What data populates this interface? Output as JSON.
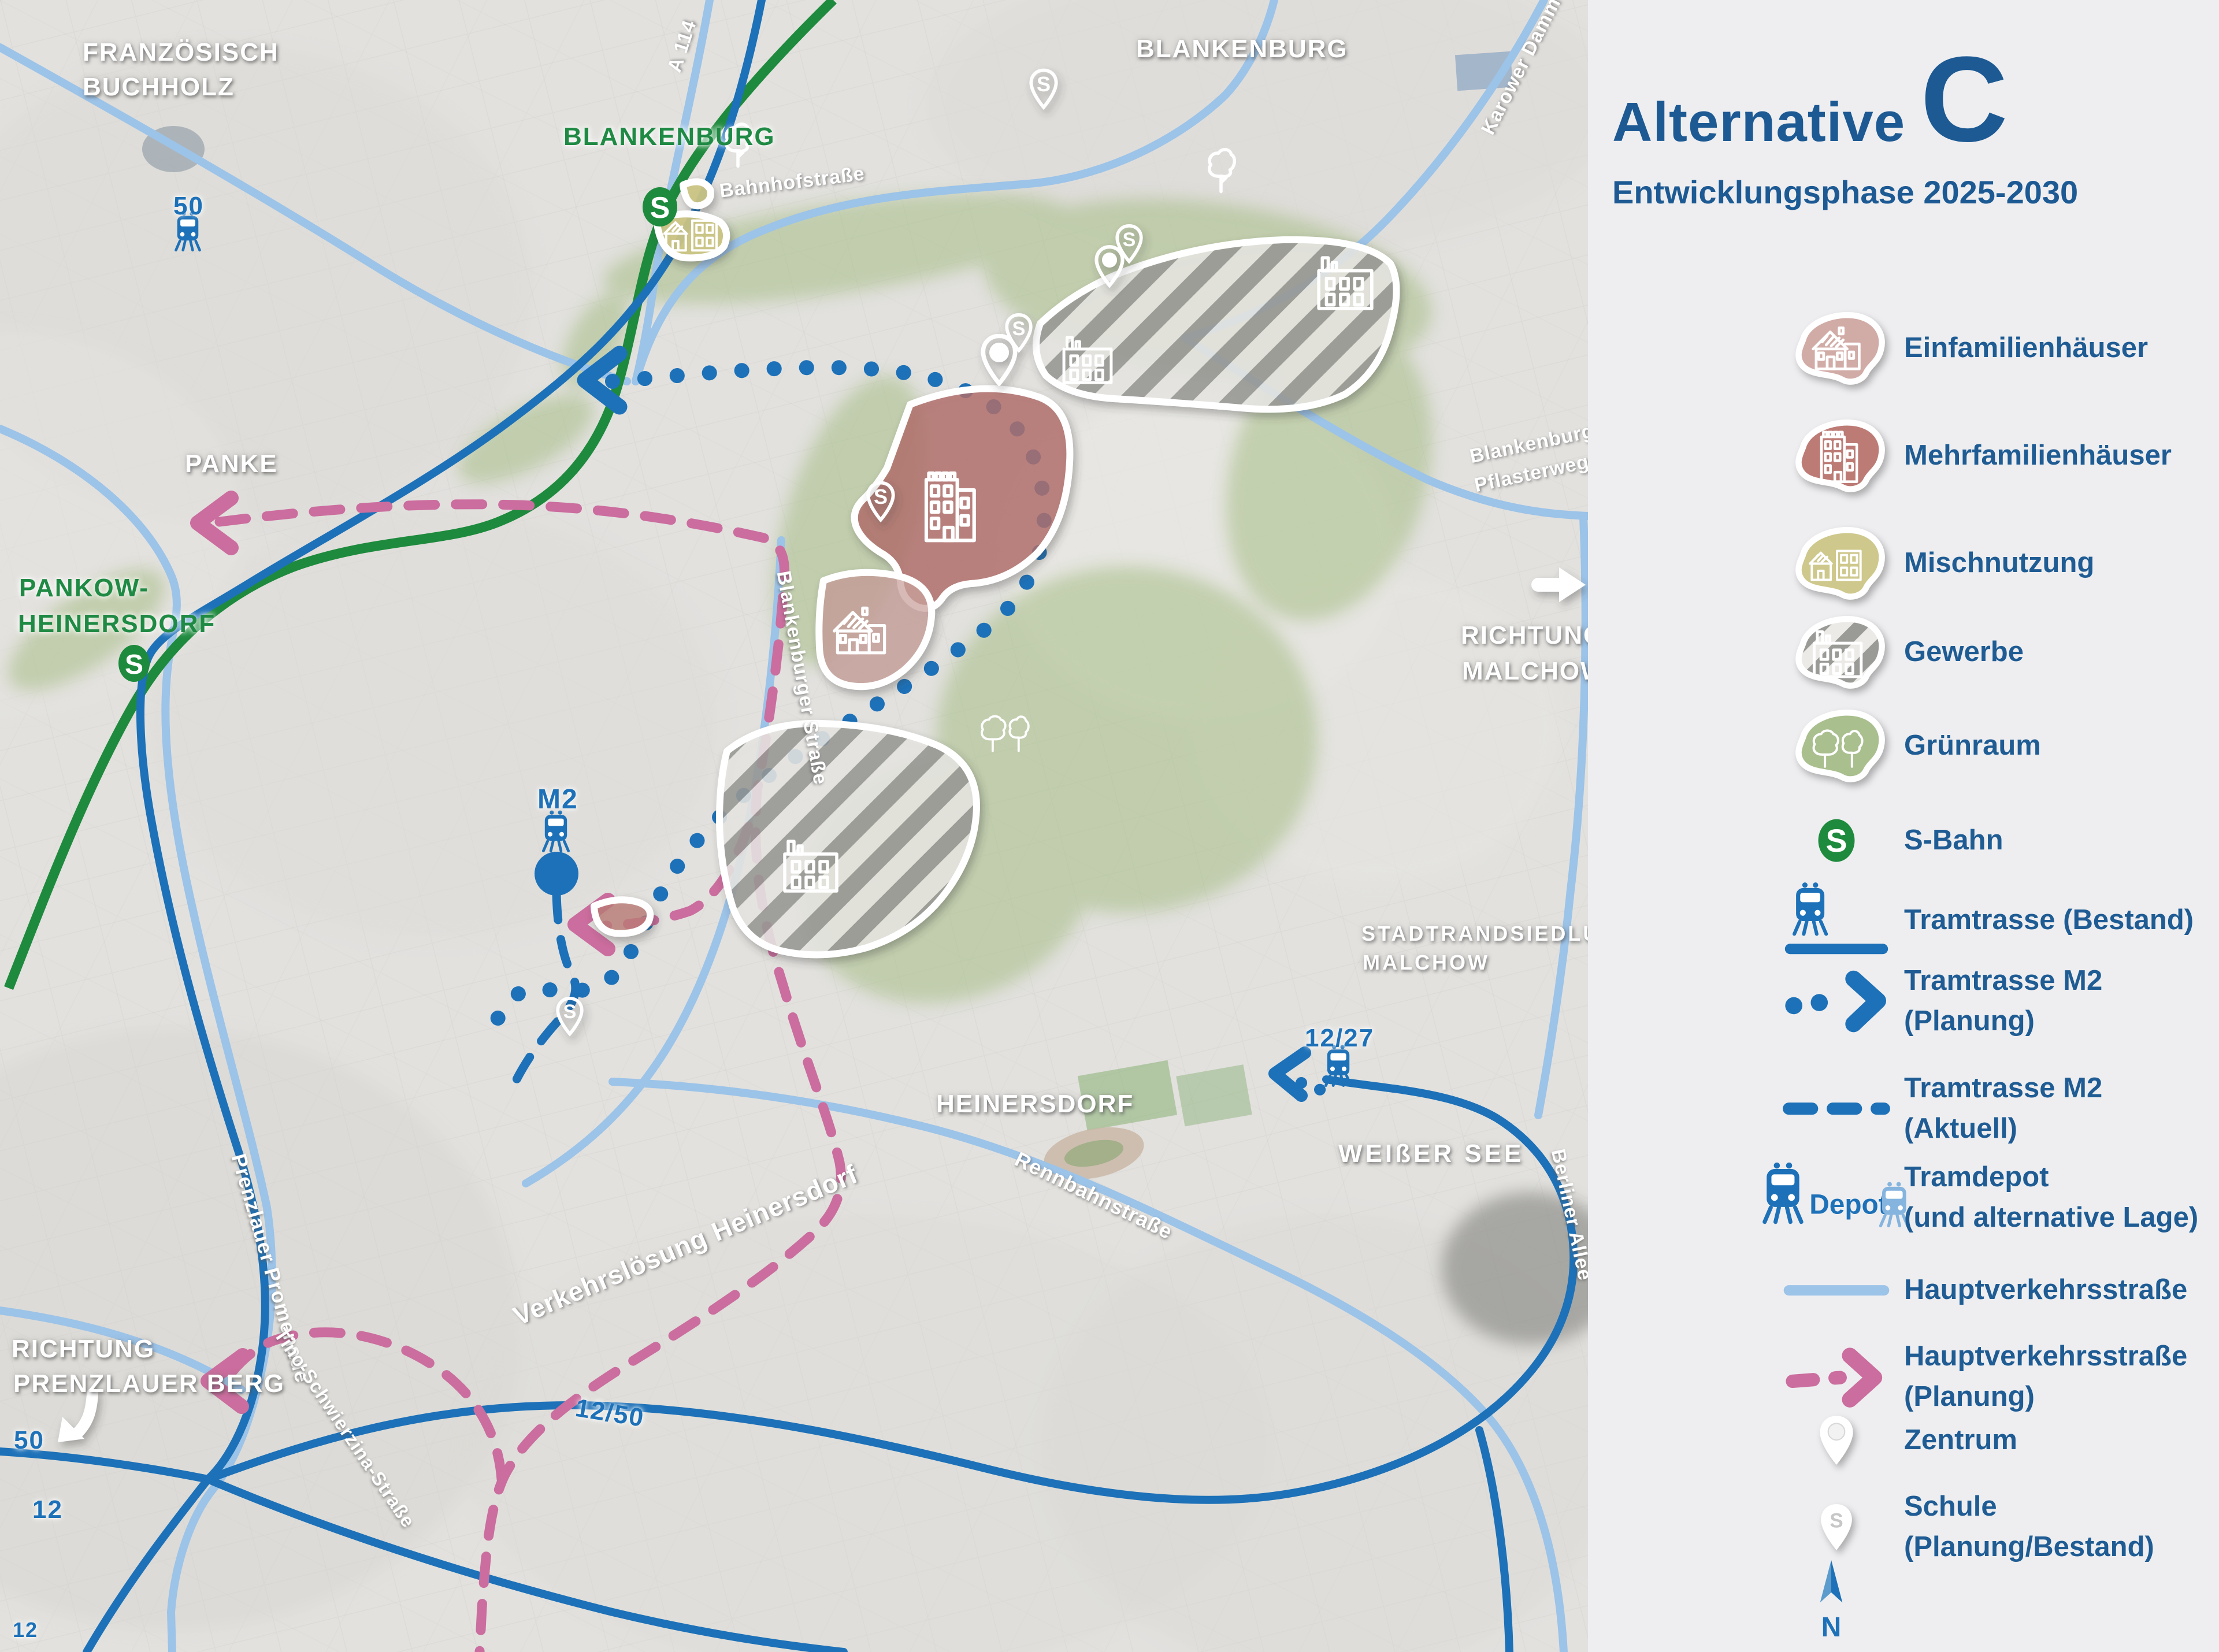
{
  "theme": {
    "accent_blue": "#1d5a94",
    "tram_blue": "#1d71b8",
    "tram_blue_light": "#85b4de",
    "road_lightblue": "#9cc3e8",
    "sbahn_green": "#1e8a3d",
    "planning_pink": "#cb6d9e",
    "einfamilien_color": "#d1aba6",
    "mehrfamilien_color": "#bd7b76",
    "mischnutzung_color": "#cec88c",
    "gruenraum_color": "#a9bf8e",
    "gewerbe_stripe_color": "#9a9a97",
    "legend_bg": "#eeeef0"
  },
  "legend": {
    "title_prefix": "Alternative",
    "title_letter": "C",
    "subtitle": "Entwicklungsphase 2025-2030",
    "depot_label": "Depot",
    "compass_letter": "N",
    "sbahn_letter": "S",
    "schule_letter": "S",
    "items": [
      {
        "label": "Einfamilienhäuser"
      },
      {
        "label": "Mehrfamilienhäuser"
      },
      {
        "label": "Mischnutzung"
      },
      {
        "label": "Gewerbe"
      },
      {
        "label": "Grünraum"
      },
      {
        "label": "S-Bahn"
      },
      {
        "label": "Tramtrasse (Bestand)"
      },
      {
        "label": "Tramtrasse M2",
        "label2": "(Planung)"
      },
      {
        "label": "Tramtrasse M2",
        "label2": "(Aktuell)"
      },
      {
        "label": "Tramdepot",
        "label2": "(und alternative Lage)"
      },
      {
        "label": "Hauptverkehrsstraße"
      },
      {
        "label": "Hauptverkehrsstraße",
        "label2": "(Planung)"
      },
      {
        "label": "Zentrum"
      },
      {
        "label": "Schule",
        "label2": "(Planung/Bestand)"
      }
    ]
  },
  "map": {
    "sbahn_letter": "S",
    "pin_letter": "S",
    "area_labels": {
      "franzoesisch_line1": "FRANZÖSISCH",
      "franzoesisch_line2": "BUCHHOLZ",
      "blankenburg_green": "BLANKENBURG",
      "blankenburg": "BLANKENBURG",
      "panke": "PANKE",
      "pankow_line1": "PANKOW-",
      "pankow_line2": "HEINERSDORF",
      "richtung_malchow_line1": "RICHTUNG",
      "richtung_malchow_line2": "MALCHOW",
      "stadtrand_line1": "STADTRANDSIEDLUNG",
      "stadtrand_line2": "MALCHOW",
      "heinersdorf": "HEINERSDORF",
      "weisser_see": "WEIßER SEE",
      "richtung_pb_line1": "RICHTUNG",
      "richtung_pb_line2": "PRENZLAUER BERG"
    },
    "street_labels": {
      "a114": "A 114",
      "karower_damm": "Karower Damm",
      "bahnhofstrasse": "Bahnhofstraße",
      "pflasterweg_line1": "Blankenburger",
      "pflasterweg_line2": "Pflasterweg",
      "blankenburger_strasse": "Blankenburger Straße",
      "rennbahnstrasse": "Rennbahnstraße",
      "verkehrsloesung": "Verkehrslösung Heinersdorf",
      "prenzlauer_promenade": "Prenzlauer Promenade",
      "tino_schwierzina": "Tino-Schwierzina-Straße",
      "berliner_allee": "Berliner Allee"
    },
    "route_labels": {
      "tram50_top": "50",
      "m2": "M2",
      "tram1227": "12/27",
      "tram1250": "12/50",
      "tram50_bottom": "50",
      "tram12": "12",
      "tram12_edge": "12"
    }
  }
}
